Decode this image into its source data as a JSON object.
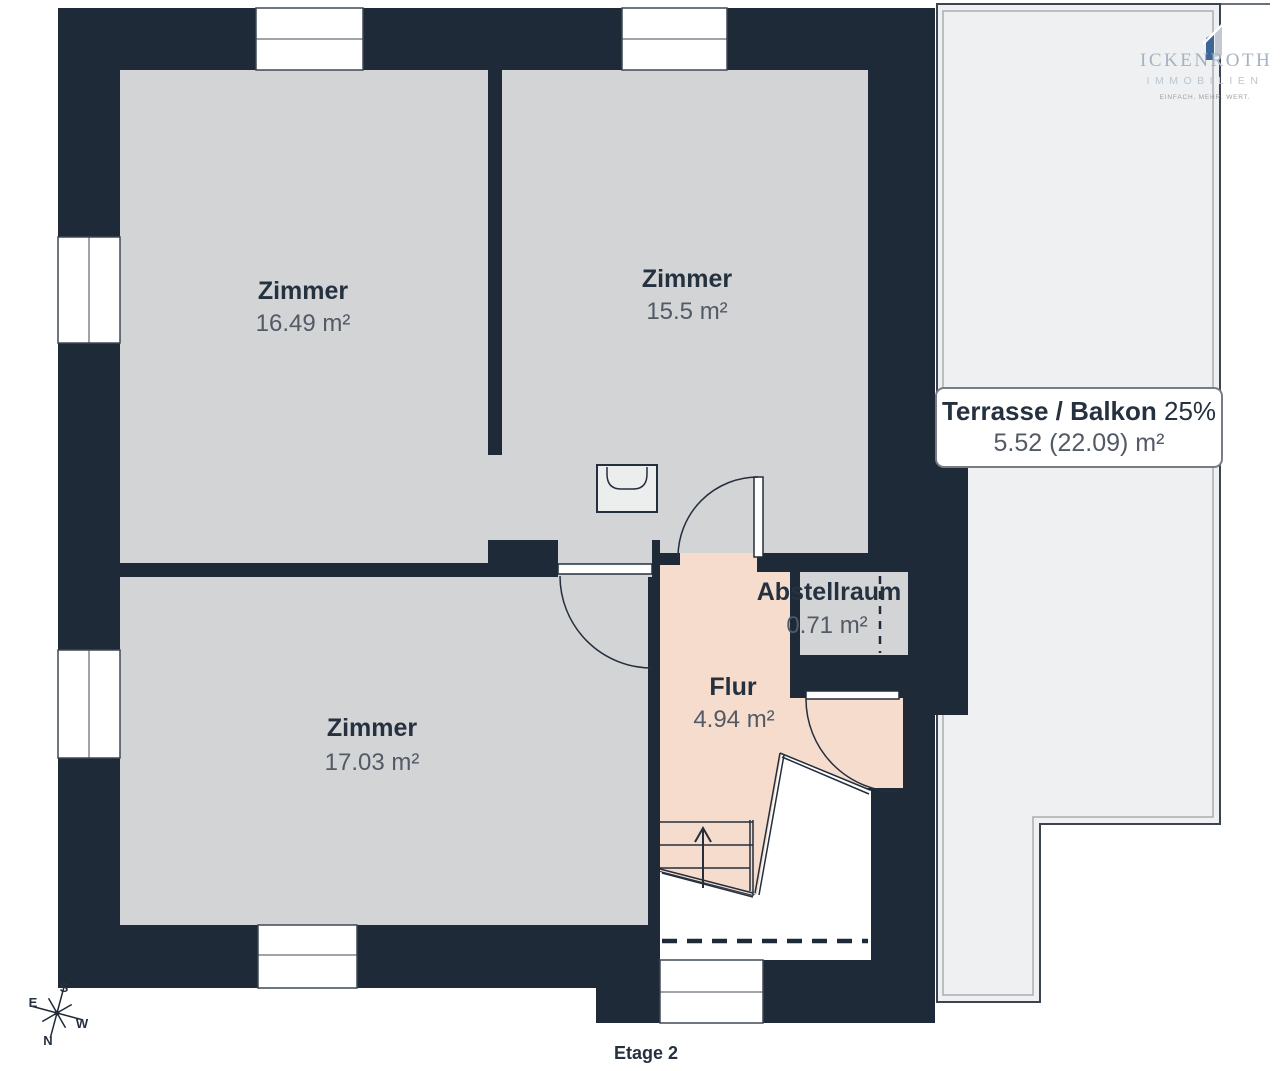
{
  "plan": {
    "floor_caption": "Etage 2",
    "rooms": [
      {
        "name": "Zimmer",
        "area": "16.49 m²"
      },
      {
        "name": "Zimmer",
        "area": "15.5 m²"
      },
      {
        "name": "Zimmer",
        "area": "17.03 m²"
      },
      {
        "name": "Abstellraum",
        "area": "0.71 m²"
      },
      {
        "name": "Flur",
        "area": "4.94 m²"
      }
    ],
    "terrace": {
      "name": "Terrasse / Balkon",
      "percent": "25%",
      "area": "5.52 (22.09) m²"
    },
    "compass": {
      "n": "N",
      "e": "E",
      "s": "S",
      "w": "W"
    }
  },
  "logo": {
    "name": "ICKENROTH",
    "subtitle": "IMMOBILIEN",
    "tagline": "EINFACH. MEHR. WERT."
  },
  "colors": {
    "wall": "#1f2a38",
    "room": "#d2d4d6",
    "hallway": "#f5dccd",
    "terrace": "#eff0f1",
    "ink": "#26313f",
    "muted": "#525a66",
    "logo_blue": "#a3b3c3",
    "logo_accent": "#3d6595"
  }
}
